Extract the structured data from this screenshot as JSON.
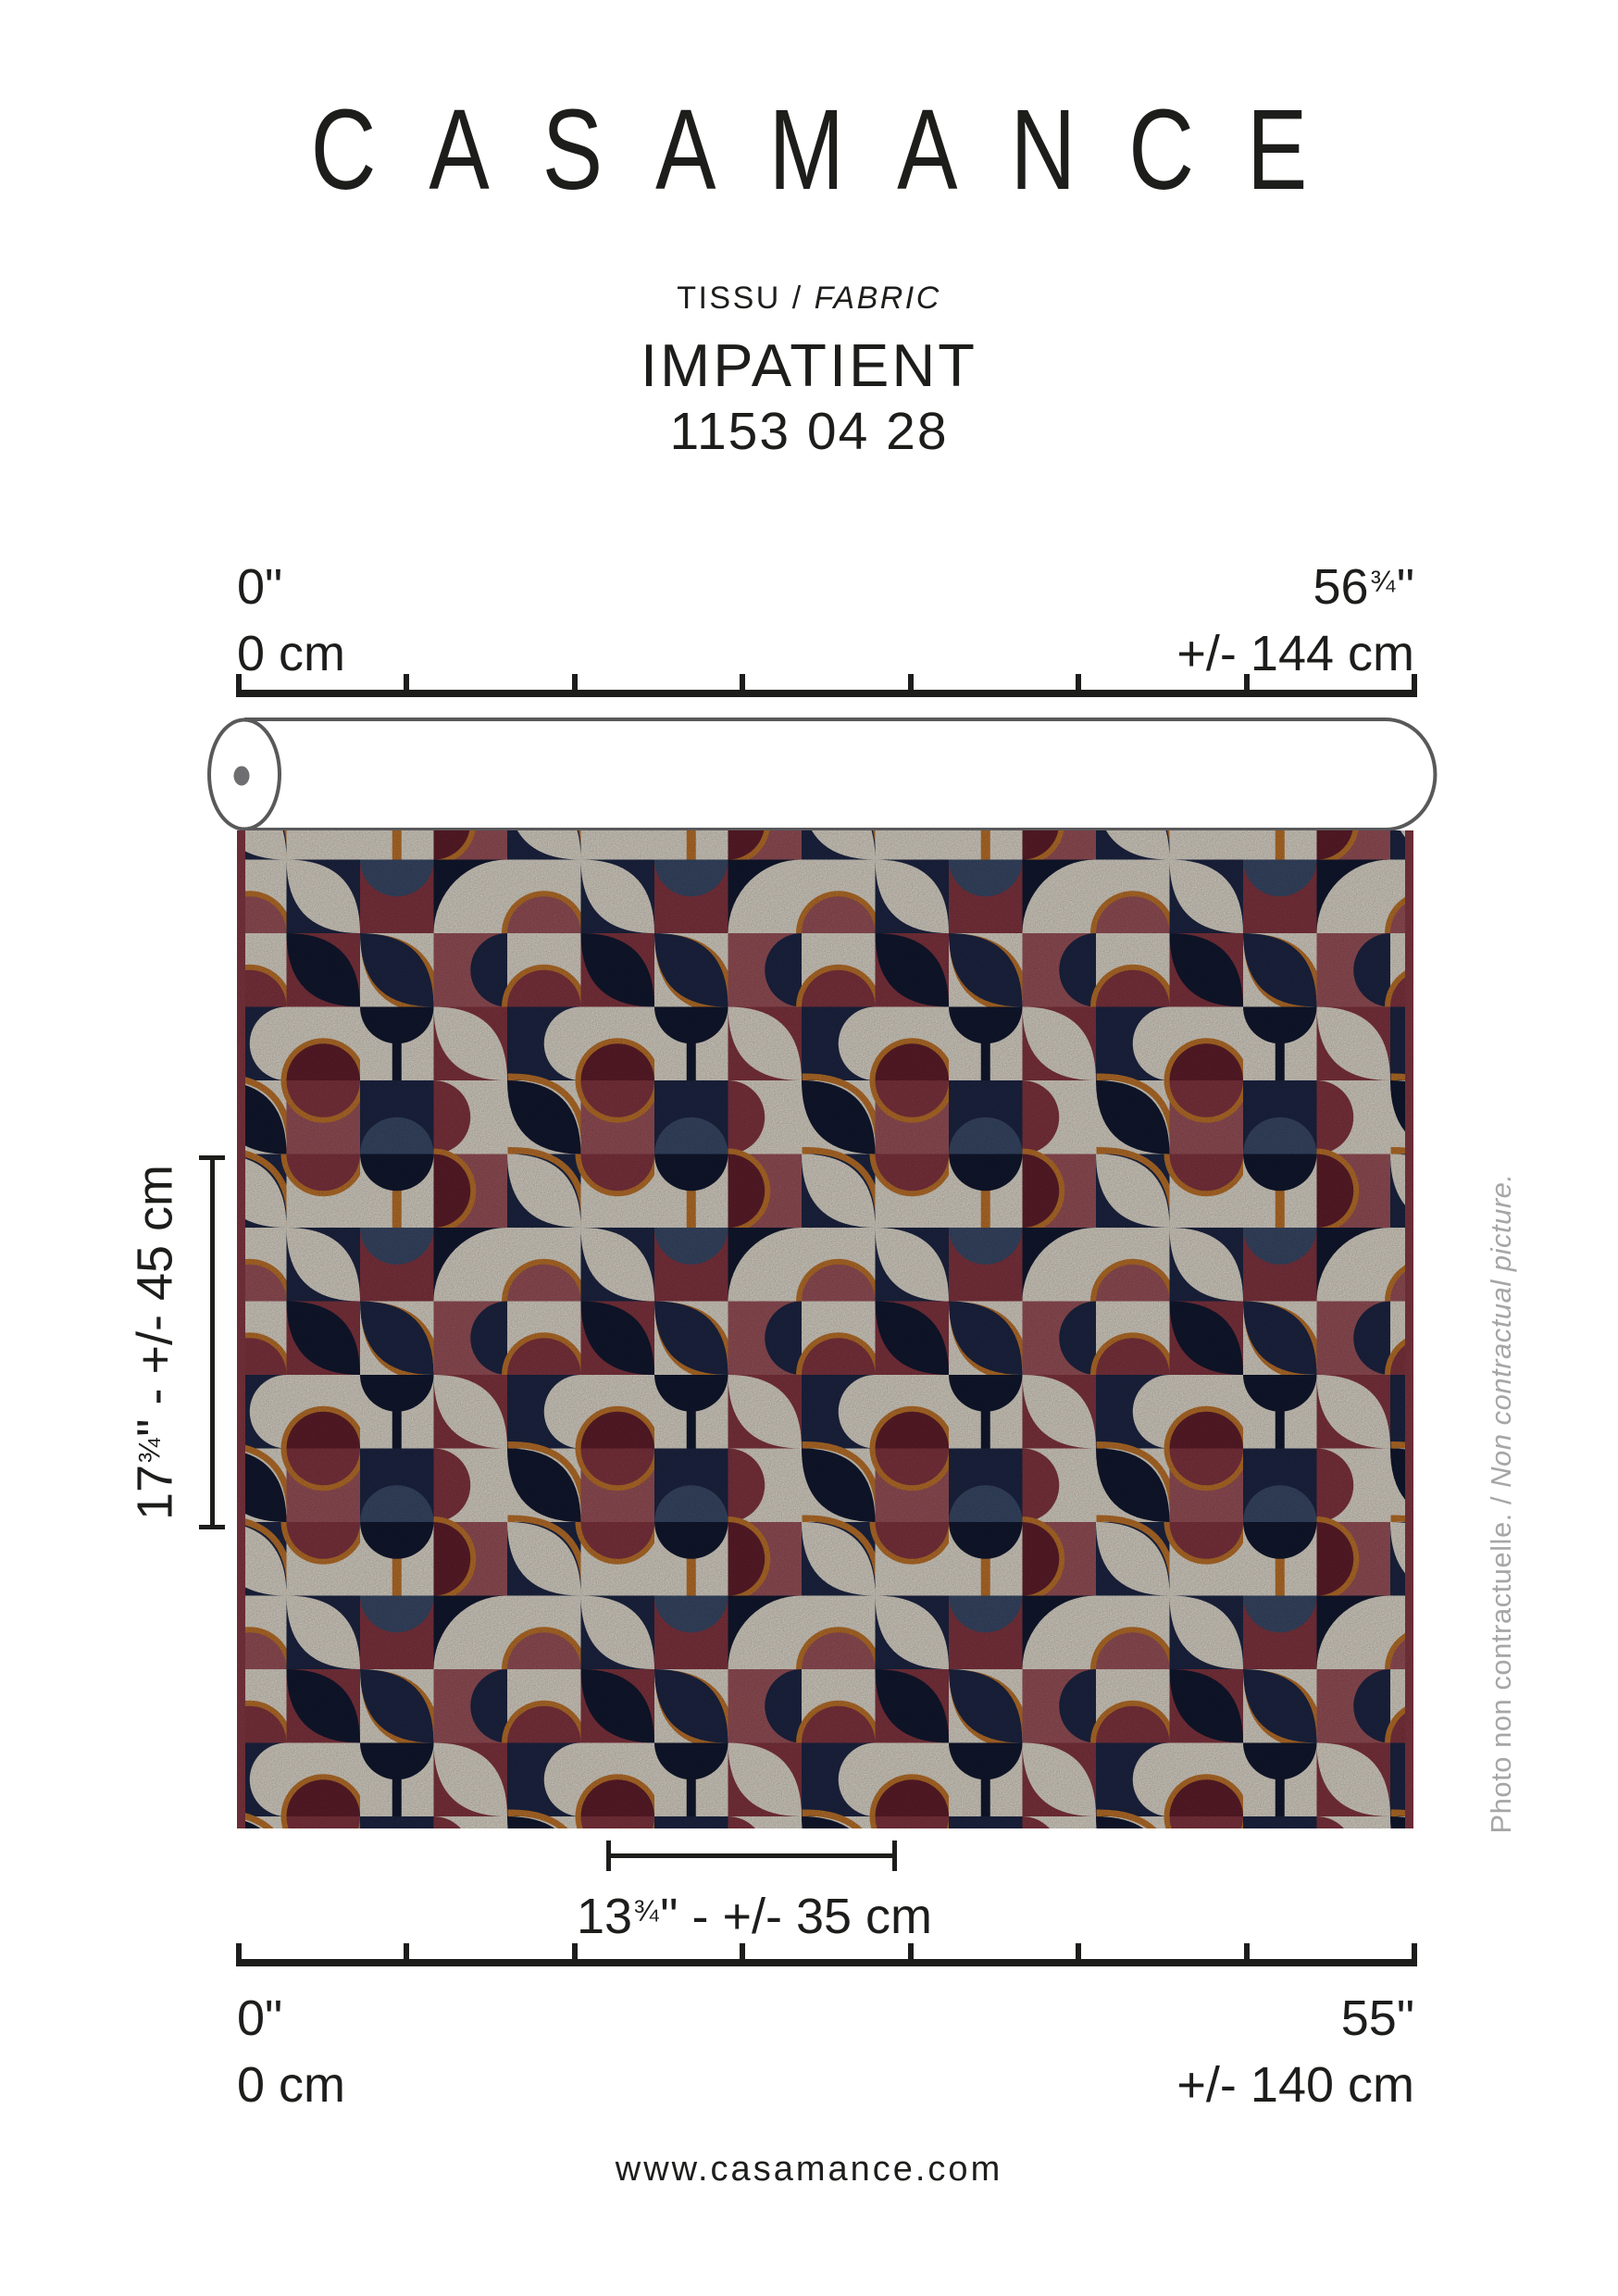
{
  "brand": {
    "title": "CASAMANCE"
  },
  "product": {
    "category_fr": "TISSU / ",
    "category_en": "FABRIC",
    "name": "IMPATIENT",
    "code": "1153 04 28"
  },
  "top_ruler": {
    "left_inches": "0\"",
    "left_cm": "0 cm",
    "right_inches_main": "56",
    "right_inches_frac": "¾",
    "right_inches_unit": "\"",
    "right_cm": "+/- 144 cm",
    "tick_count": 8
  },
  "bottom_ruler": {
    "left_inches": "0\"",
    "left_cm": "0 cm",
    "right_inches": "55\"",
    "right_cm": "+/- 140 cm",
    "tick_count": 8
  },
  "vertical_measure": {
    "main": "17",
    "frac": "¾",
    "rest": "\" - +/- 45 cm"
  },
  "repeat_measure": {
    "main": "13",
    "frac": "¾",
    "rest": "\" - +/- 35 cm"
  },
  "caption": {
    "fr": "Photo non contractuelle. / ",
    "en": "Non contractual picture."
  },
  "footer": {
    "website": "www.casamance.com"
  },
  "ink_color": "#1d1d1b",
  "caption_color": "#a6a6a6",
  "roll": {
    "stroke": "#59595b",
    "fill": "#ffffff",
    "core_dot": "#6e6e70"
  },
  "fabric": {
    "colors": {
      "cream": "#ece5d8",
      "navy": "#1f2848",
      "navy2": "#131a33",
      "slate": "#3d4e6e",
      "burg": "#8a3844",
      "wine": "#66202e",
      "rose": "#a2575f",
      "orange": "#c8792d",
      "selvage": "#8e3c48"
    },
    "selvage_width": 9,
    "cell_size": 79.5,
    "tile_cols": 4,
    "tile_rows": 5,
    "tile": [
      {
        "bg": "navy",
        "s": [
          [
            "leaf",
            "cream",
            0,
            true
          ]
        ]
      },
      {
        "bg": "cream",
        "s": [
          [
            "half",
            "burg",
            0,
            true
          ]
        ]
      },
      {
        "bg": "cream",
        "s": [
          [
            "stem",
            "orange",
            0,
            false
          ],
          [
            "half",
            "navy2",
            0,
            false
          ]
        ]
      },
      {
        "bg": "rose",
        "s": [
          [
            "half",
            "wine",
            3,
            true
          ]
        ]
      },
      {
        "bg": "cream",
        "s": [
          [
            "half",
            "rose",
            2,
            true
          ]
        ]
      },
      {
        "bg": "navy",
        "s": [
          [
            "leaf",
            "cream",
            1,
            false
          ]
        ]
      },
      {
        "bg": "burg",
        "s": [
          [
            "half",
            "slate",
            0,
            false
          ]
        ]
      },
      {
        "bg": "navy2",
        "s": [
          [
            "q",
            "cream",
            2,
            false
          ]
        ]
      },
      {
        "bg": "cream",
        "s": [
          [
            "half",
            "burg",
            2,
            true
          ]
        ]
      },
      {
        "bg": "burg",
        "s": [
          [
            "leaf",
            "navy2",
            0,
            false
          ]
        ]
      },
      {
        "bg": "cream",
        "s": [
          [
            "leaf",
            "navy",
            1,
            true
          ]
        ]
      },
      {
        "bg": "rose",
        "s": [
          [
            "half",
            "navy",
            1,
            false
          ]
        ]
      },
      {
        "bg": "navy",
        "s": [
          [
            "half",
            "cream",
            1,
            false
          ]
        ]
      },
      {
        "bg": "cream",
        "s": [
          [
            "half",
            "wine",
            2,
            true
          ]
        ]
      },
      {
        "bg": "cream",
        "s": [
          [
            "stem",
            "navy2",
            0,
            false
          ],
          [
            "half",
            "navy2",
            0,
            false
          ]
        ]
      },
      {
        "bg": "burg",
        "s": [
          [
            "leaf",
            "cream",
            1,
            false
          ]
        ]
      },
      {
        "bg": "cream",
        "s": [
          [
            "leaf",
            "navy2",
            0,
            true
          ]
        ]
      },
      {
        "bg": "rose",
        "s": [
          [
            "half",
            "burg",
            0,
            true
          ]
        ]
      },
      {
        "bg": "navy",
        "s": [
          [
            "half",
            "slate",
            2,
            false
          ]
        ]
      },
      {
        "bg": "cream",
        "s": [
          [
            "half",
            "burg",
            3,
            false
          ]
        ]
      }
    ]
  }
}
